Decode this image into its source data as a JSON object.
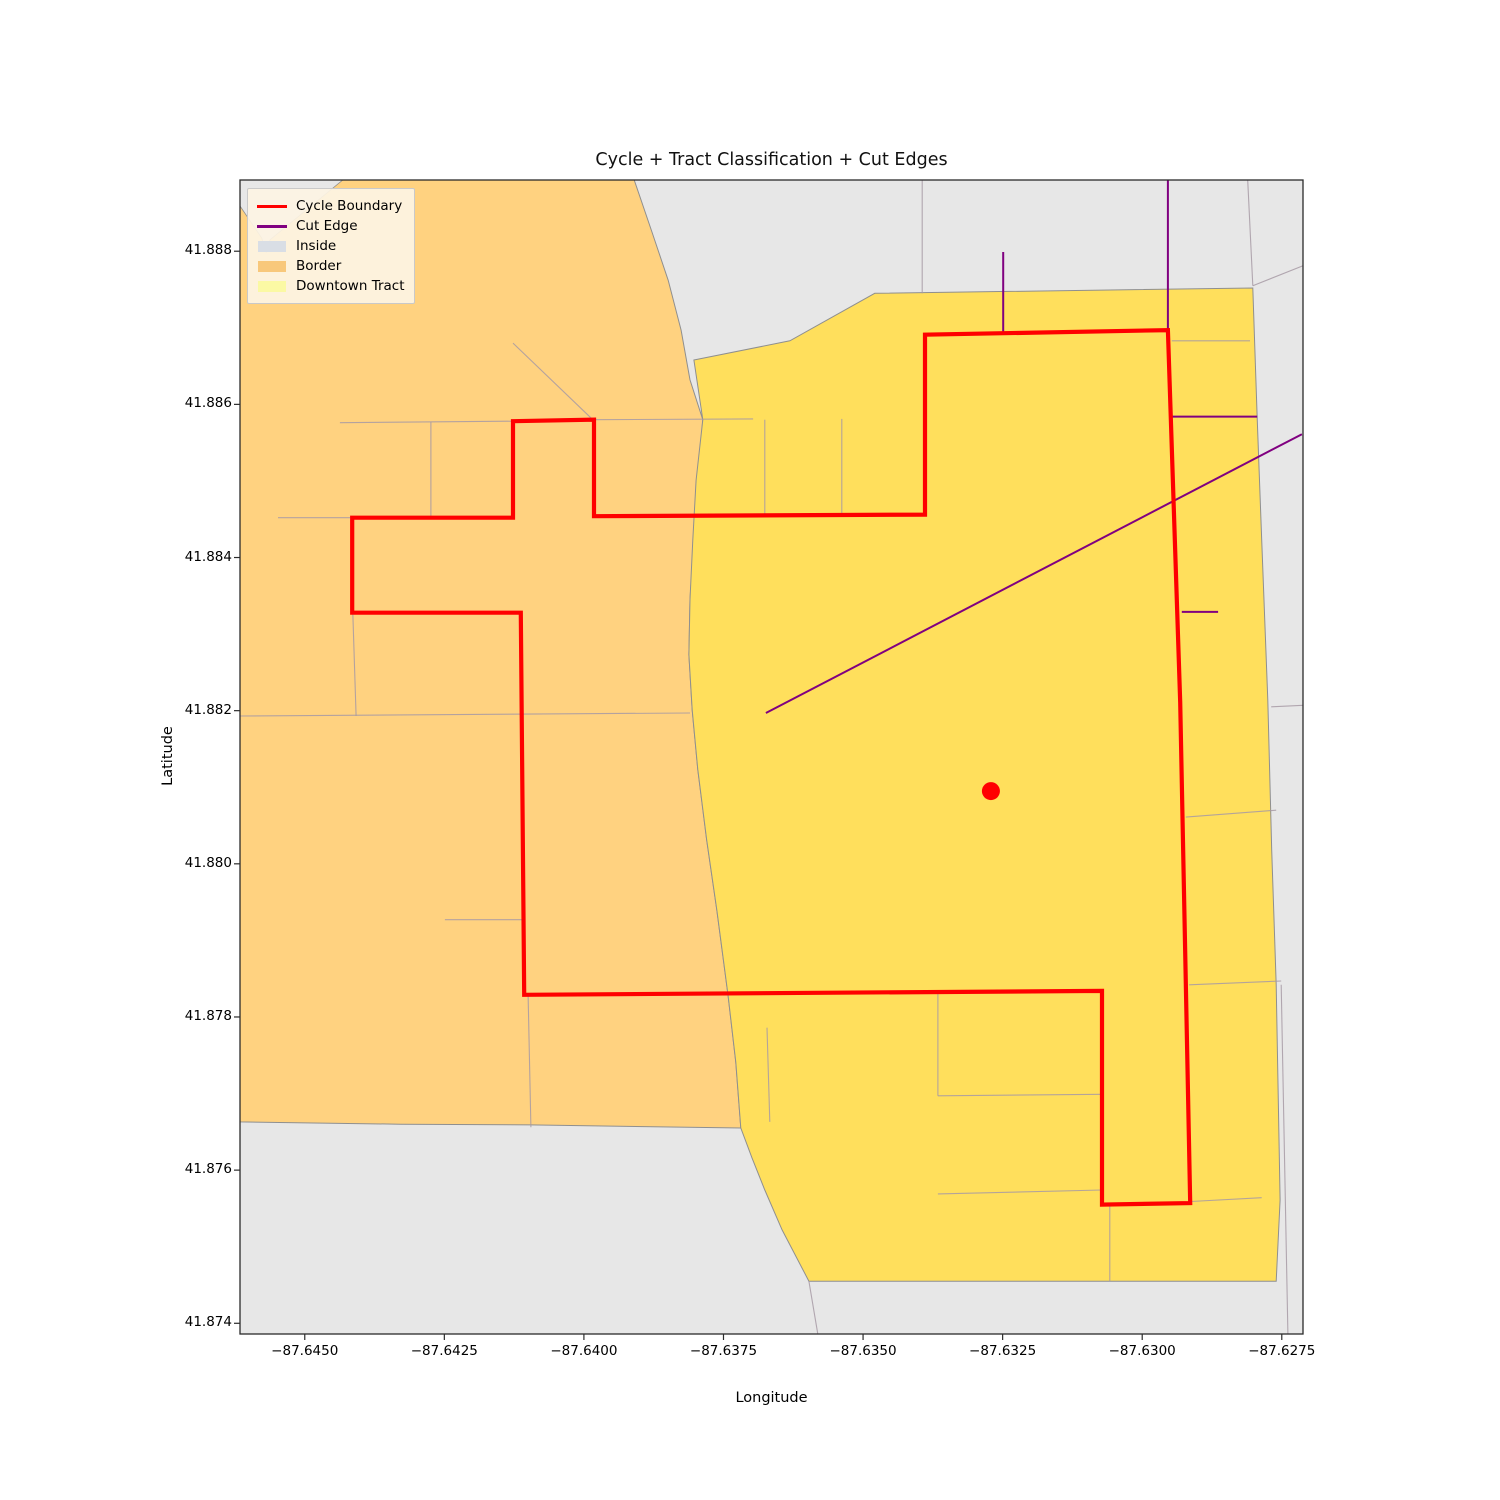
{
  "title": "Cycle + Tract Classification + Cut Edges",
  "axes": {
    "xlabel": "Longitude",
    "ylabel": "Latitude",
    "x_range": [
      -87.64616,
      -87.62712
    ],
    "y_range": [
      41.87386,
      41.88893
    ],
    "x_ticks": [
      {
        "value": -87.645,
        "label": "−87.6450"
      },
      {
        "value": -87.6425,
        "label": "−87.6425"
      },
      {
        "value": -87.64,
        "label": "−87.6400"
      },
      {
        "value": -87.6375,
        "label": "−87.6375"
      },
      {
        "value": -87.635,
        "label": "−87.6350"
      },
      {
        "value": -87.6325,
        "label": "−87.6325"
      },
      {
        "value": -87.63,
        "label": "−87.6300"
      },
      {
        "value": -87.6275,
        "label": "−87.6275"
      }
    ],
    "y_ticks": [
      {
        "value": 41.888,
        "label": "41.888"
      },
      {
        "value": 41.886,
        "label": "41.886"
      },
      {
        "value": 41.884,
        "label": "41.884"
      },
      {
        "value": 41.882,
        "label": "41.882"
      },
      {
        "value": 41.88,
        "label": "41.880"
      },
      {
        "value": 41.878,
        "label": "41.878"
      },
      {
        "value": 41.876,
        "label": "41.876"
      },
      {
        "value": 41.874,
        "label": "41.874"
      }
    ]
  },
  "legend": {
    "items": [
      {
        "label": "Cycle Boundary",
        "type": "line",
        "color": "#ff0000"
      },
      {
        "label": "Cut Edge",
        "type": "line",
        "color": "#800080"
      },
      {
        "label": "Inside",
        "type": "patch",
        "color": "#d9dee5",
        "hatch": false
      },
      {
        "label": "Border",
        "type": "patch",
        "color": "#f8c87b",
        "hatch": true
      },
      {
        "label": "Downtown Tract",
        "type": "patch",
        "color": "#fbf9a4",
        "hatch": false
      }
    ]
  },
  "colors": {
    "cycle_boundary": "#ff0000",
    "cut_edge": "#800080",
    "inside_fill": "#e7e7e7",
    "border_fill": "#ffd280",
    "downtown_fill": "#ffdf5c",
    "street": "#a79aa4",
    "region_outline": "#8f8f8f",
    "frame": "#2b2b2b",
    "seed_point": "#ff0000"
  },
  "chart_data": {
    "type": "map",
    "projection": "lon-lat",
    "border_tract": [
      [
        -87.64616,
        41.88893
      ],
      [
        -87.6391,
        41.88893
      ],
      [
        -87.63878,
        41.88825
      ],
      [
        -87.63849,
        41.88762
      ],
      [
        -87.63826,
        41.88697
      ],
      [
        -87.6381,
        41.88632
      ],
      [
        -87.63787,
        41.8858
      ],
      [
        -87.63794,
        41.88514
      ],
      [
        -87.63803,
        41.88423
      ],
      [
        -87.6381,
        41.88345
      ],
      [
        -87.63812,
        41.88273
      ],
      [
        -87.63806,
        41.88201
      ],
      [
        -87.63796,
        41.88123
      ],
      [
        -87.6378,
        41.88031
      ],
      [
        -87.63762,
        41.8794
      ],
      [
        -87.63742,
        41.87829
      ],
      [
        -87.63728,
        41.87741
      ],
      [
        -87.63719,
        41.87655
      ],
      [
        -87.64097,
        41.87659
      ],
      [
        -87.64329,
        41.8766
      ],
      [
        -87.64616,
        41.87663
      ]
    ],
    "grey_notch": [
      [
        -87.64616,
        41.88893
      ],
      [
        -87.64432,
        41.88893
      ],
      [
        -87.64562,
        41.88815
      ],
      [
        -87.64569,
        41.88799
      ],
      [
        -87.64577,
        41.88817
      ],
      [
        -87.64616,
        41.88859
      ]
    ],
    "downtown_tract": [
      [
        -87.63803,
        41.88658
      ],
      [
        -87.63631,
        41.88683
      ],
      [
        -87.63479,
        41.88745
      ],
      [
        -87.62802,
        41.88752
      ],
      [
        -87.62794,
        41.88582
      ],
      [
        -87.62786,
        41.88423
      ],
      [
        -87.62775,
        41.88214
      ],
      [
        -87.62768,
        41.88018
      ],
      [
        -87.6276,
        41.87842
      ],
      [
        -87.62753,
        41.87561
      ],
      [
        -87.6276,
        41.87455
      ],
      [
        -87.63597,
        41.87455
      ],
      [
        -87.63645,
        41.87522
      ],
      [
        -87.63676,
        41.87574
      ],
      [
        -87.63699,
        41.87616
      ],
      [
        -87.63719,
        41.87655
      ],
      [
        -87.63728,
        41.87741
      ],
      [
        -87.63742,
        41.87829
      ],
      [
        -87.63762,
        41.8794
      ],
      [
        -87.6378,
        41.88031
      ],
      [
        -87.63796,
        41.88123
      ],
      [
        -87.63806,
        41.88201
      ],
      [
        -87.63812,
        41.88273
      ],
      [
        -87.6381,
        41.88345
      ],
      [
        -87.63805,
        41.88423
      ],
      [
        -87.63799,
        41.88501
      ],
      [
        -87.63787,
        41.8858
      ]
    ],
    "cycle_boundary": [
      [
        -87.64127,
        41.88578
      ],
      [
        -87.63982,
        41.8858
      ],
      [
        -87.63982,
        41.88454
      ],
      [
        -87.63389,
        41.88456
      ],
      [
        -87.63389,
        41.88691
      ],
      [
        -87.62954,
        41.88697
      ],
      [
        -87.62932,
        41.88211
      ],
      [
        -87.62914,
        41.87557
      ],
      [
        -87.63072,
        41.87555
      ],
      [
        -87.63072,
        41.87834
      ],
      [
        -87.64107,
        41.87829
      ],
      [
        -87.64113,
        41.88328
      ],
      [
        -87.64415,
        41.88328
      ],
      [
        -87.64415,
        41.88452
      ],
      [
        -87.64127,
        41.88452
      ]
    ],
    "cut_edges": [
      [
        [
          -87.63674,
          41.88197
        ],
        [
          -87.62714,
          41.88561
        ]
      ],
      [
        [
          -87.62954,
          41.88893
        ],
        [
          -87.62954,
          41.88697
        ]
      ],
      [
        [
          -87.62947,
          41.88584
        ],
        [
          -87.62794,
          41.88584
        ]
      ],
      [
        [
          -87.62929,
          41.88329
        ],
        [
          -87.62864,
          41.88329
        ]
      ],
      [
        [
          -87.63249,
          41.88799
        ],
        [
          -87.63249,
          41.88693
        ]
      ]
    ],
    "streets": [
      [
        [
          -87.64616,
          41.88193
        ],
        [
          -87.6381,
          41.88197
        ]
      ],
      [
        [
          -87.64249,
          41.87927
        ],
        [
          -87.64109,
          41.87927
        ]
      ],
      [
        [
          -87.64414,
          41.88328
        ],
        [
          -87.64408,
          41.88193
        ]
      ],
      [
        [
          -87.64274,
          41.88577
        ],
        [
          -87.64274,
          41.88454
        ]
      ],
      [
        [
          -87.64437,
          41.88576
        ],
        [
          -87.64127,
          41.88578
        ]
      ],
      [
        [
          -87.64548,
          41.88452
        ],
        [
          -87.64415,
          41.88452
        ]
      ],
      [
        [
          -87.64127,
          41.8868
        ],
        [
          -87.63984,
          41.8858
        ]
      ],
      [
        [
          -87.63982,
          41.8858
        ],
        [
          -87.63697,
          41.88581
        ]
      ],
      [
        [
          -87.63676,
          41.8858
        ],
        [
          -87.63676,
          41.88454
        ]
      ],
      [
        [
          -87.63538,
          41.88581
        ],
        [
          -87.63538,
          41.88456
        ]
      ],
      [
        [
          -87.63394,
          41.88893
        ],
        [
          -87.63394,
          41.88745
        ]
      ],
      [
        [
          -87.62811,
          41.88893
        ],
        [
          -87.62802,
          41.88755
        ]
      ],
      [
        [
          -87.62802,
          41.88755
        ],
        [
          -87.62712,
          41.88781
        ]
      ],
      [
        [
          -87.62947,
          41.88683
        ],
        [
          -87.62807,
          41.88683
        ]
      ],
      [
        [
          -87.62922,
          41.88061
        ],
        [
          -87.6276,
          41.8807
        ]
      ],
      [
        [
          -87.62769,
          41.88205
        ],
        [
          -87.62712,
          41.88207
        ]
      ],
      [
        [
          -87.62916,
          41.87842
        ],
        [
          -87.62751,
          41.87847
        ]
      ],
      [
        [
          -87.63366,
          41.87833
        ],
        [
          -87.63366,
          41.87697
        ]
      ],
      [
        [
          -87.63366,
          41.87697
        ],
        [
          -87.63072,
          41.87699
        ]
      ],
      [
        [
          -87.63366,
          41.87569
        ],
        [
          -87.63072,
          41.87574
        ]
      ],
      [
        [
          -87.63058,
          41.87555
        ],
        [
          -87.63058,
          41.87455
        ]
      ],
      [
        [
          -87.62913,
          41.87559
        ],
        [
          -87.62786,
          41.87564
        ]
      ],
      [
        [
          -87.641,
          41.87829
        ],
        [
          -87.64095,
          41.87656
        ]
      ],
      [
        [
          -87.63672,
          41.87786
        ],
        [
          -87.63667,
          41.87663
        ]
      ],
      [
        [
          -87.63597,
          41.87455
        ],
        [
          -87.63581,
          41.87386
        ]
      ],
      [
        [
          -87.62751,
          41.87842
        ],
        [
          -87.62739,
          41.87386
        ]
      ]
    ],
    "seed_point": {
      "lon": -87.63271,
      "lat": 41.88095
    }
  }
}
